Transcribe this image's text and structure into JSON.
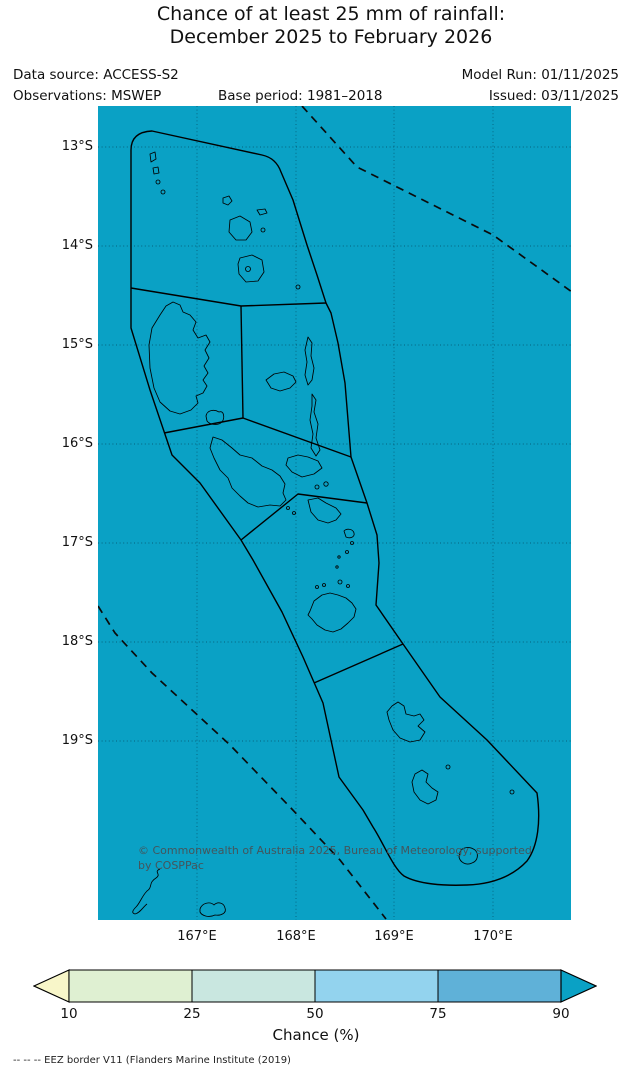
{
  "title": {
    "line1": "Chance of at least 25 mm of rainfall:",
    "line2": "December 2025 to February 2026"
  },
  "meta": {
    "data_source": "Data source: ACCESS-S2",
    "model_run": "Model Run: 01/11/2025",
    "observations": "Observations: MSWEP",
    "base_period": "Base period: 1981–2018",
    "issued": "Issued: 03/11/2025"
  },
  "map": {
    "sea_color": "#0aa1c5",
    "lat_labels": [
      "13°S",
      "14°S",
      "15°S",
      "16°S",
      "17°S",
      "18°S",
      "19°S"
    ],
    "lon_labels": [
      "167°E",
      "168°E",
      "169°E",
      "170°E"
    ],
    "copyright": {
      "line1": "© Commonwealth of Australia 2025, Bureau of Meteorology, supported",
      "line2": "by COSPPac"
    }
  },
  "colorbar": {
    "label": "Chance (%)",
    "ticks": [
      "10",
      "25",
      "50",
      "75",
      "90"
    ],
    "arrow_left_color": "#f8f6c9",
    "segment_colors": [
      "#dff0d2",
      "#c9e7e0",
      "#93d3ee",
      "#5fb1d8"
    ],
    "arrow_right_color": "#0aa1c5",
    "outline_color": "#000000"
  },
  "footnote": "-- -- -- EEZ border V11 (Flanders Marine Institute (2019)",
  "chart_data": {
    "type": "heatmap",
    "title": "Chance of at least 25 mm of rainfall: December 2025 to February 2026",
    "legend_label": "Chance (%)",
    "legend_ticks": [
      10,
      25,
      50,
      75,
      90
    ],
    "legend_classes": [
      "<10",
      "10-25",
      "25-50",
      "50-75",
      "75-90",
      ">90"
    ],
    "lat_ticks": [
      "13°S",
      "14°S",
      "15°S",
      "16°S",
      "17°S",
      "18°S",
      "19°S"
    ],
    "lon_ticks": [
      "167°E",
      "168°E",
      "169°E",
      "170°E"
    ],
    "depicted_value": "Entire mapped Vanuatu forecast region shaded in the >90% chance class"
  }
}
